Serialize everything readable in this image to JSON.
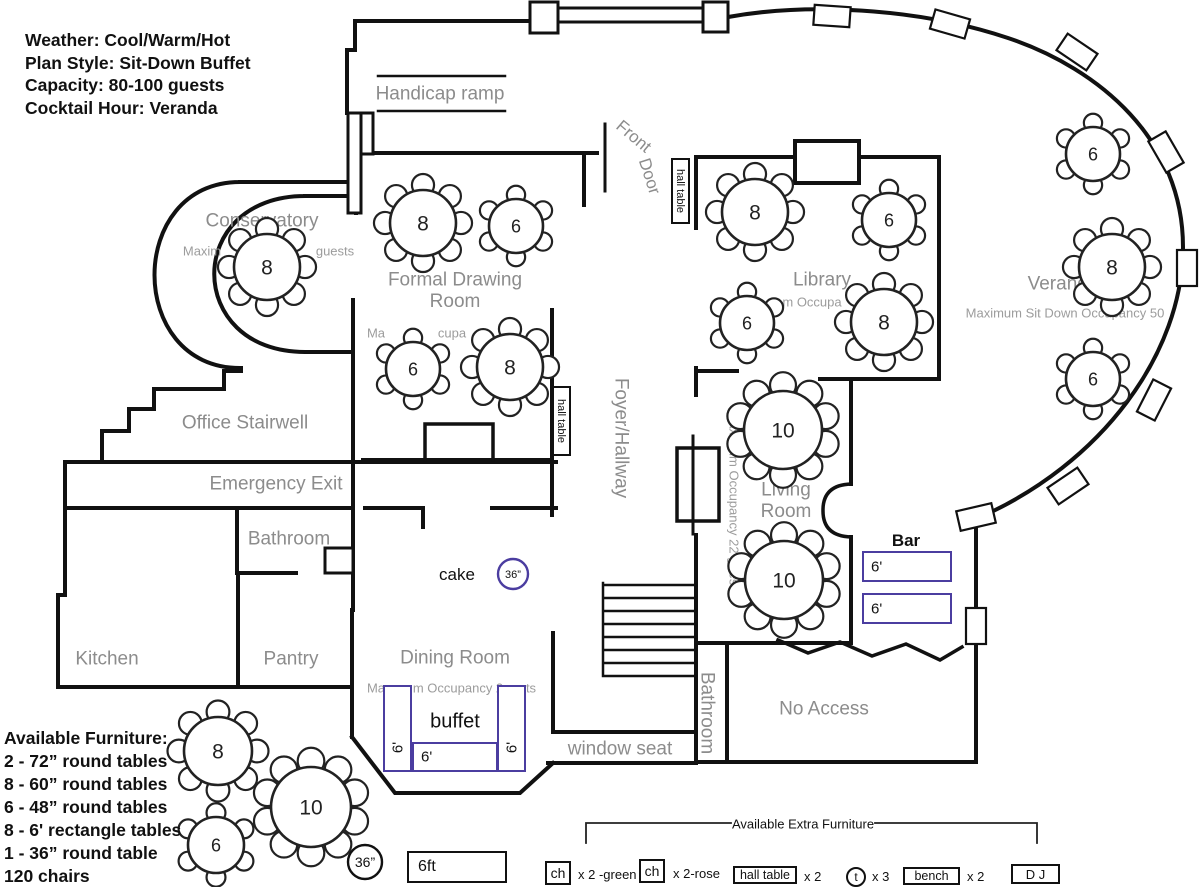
{
  "info_panel": {
    "lines": [
      "Weather: Cool/Warm/Hot",
      "Plan Style: Sit-Down Buffet",
      "Capacity: 80-100 guests",
      "Cocktail Hour: Veranda"
    ]
  },
  "furniture_panel": {
    "title": "Available Furniture:",
    "items": [
      "2 - 72” round tables",
      "8 - 60” round tables",
      "6 - 48” round tables",
      "8 - 6' rectangle tables",
      "1 - 36” round table",
      "120 chairs"
    ]
  },
  "plan": {
    "room_labels": [
      {
        "id": "conservatory",
        "text": "Conservatory",
        "x": 262,
        "y": 220,
        "size": 19,
        "rot": 0
      },
      {
        "id": "formal-drawing-room",
        "text": "Formal Drawing\nRoom",
        "x": 455,
        "y": 290,
        "size": 19,
        "rot": 0
      },
      {
        "id": "library",
        "text": "Library",
        "x": 822,
        "y": 279,
        "size": 19,
        "rot": 0
      },
      {
        "id": "veranda",
        "text": "Veranda",
        "x": 1063,
        "y": 283,
        "size": 19,
        "rot": 0
      },
      {
        "id": "office-stairwell",
        "text": "Office Stairwell",
        "x": 245,
        "y": 422,
        "size": 19,
        "rot": 0
      },
      {
        "id": "emergency-exit",
        "text": "Emergency Exit",
        "x": 276,
        "y": 483,
        "size": 19,
        "rot": 0
      },
      {
        "id": "bathroom-left",
        "text": "Bathroom",
        "x": 289,
        "y": 538,
        "size": 19,
        "rot": 0
      },
      {
        "id": "kitchen",
        "text": "Kitchen",
        "x": 107,
        "y": 658,
        "size": 19,
        "rot": 0
      },
      {
        "id": "pantry",
        "text": "Pantry",
        "x": 291,
        "y": 658,
        "size": 19,
        "rot": 0
      },
      {
        "id": "dining-room",
        "text": "Dining Room",
        "x": 455,
        "y": 657,
        "size": 19,
        "rot": 0
      },
      {
        "id": "living-room",
        "text": "Living\nRoom",
        "x": 786,
        "y": 500,
        "size": 19,
        "rot": 0
      },
      {
        "id": "foyer-hallway",
        "text": "Foyer/Hallway",
        "x": 622,
        "y": 438,
        "size": 19,
        "rot": 90
      },
      {
        "id": "bathroom-right",
        "text": "Bathroom",
        "x": 708,
        "y": 713,
        "size": 19,
        "rot": 90
      },
      {
        "id": "no-access",
        "text": "No Access",
        "x": 824,
        "y": 708,
        "size": 19,
        "rot": 0
      },
      {
        "id": "window-seat",
        "text": "window seat",
        "x": 620,
        "y": 748,
        "size": 19,
        "rot": 0
      },
      {
        "id": "handicap-ramp",
        "text": "Handicap ramp",
        "x": 440,
        "y": 93,
        "size": 19,
        "rot": 0
      },
      {
        "id": "front-door-word-1",
        "text": "Front",
        "x": 634,
        "y": 136,
        "size": 17,
        "rot": 40
      },
      {
        "id": "front-door-word-2",
        "text": "Door",
        "x": 650,
        "y": 176,
        "size": 17,
        "rot": 72
      }
    ],
    "occupancy_notes": [
      {
        "id": "conservatory-occupancy-left",
        "text": "Maxim",
        "x": 202,
        "y": 251,
        "rot": 0
      },
      {
        "id": "conservatory-occupancy-right",
        "text": "guests",
        "x": 335,
        "y": 251,
        "rot": 0
      },
      {
        "id": "formal-drawing-occupancy-left",
        "text": "Ma",
        "x": 376,
        "y": 333,
        "rot": 0
      },
      {
        "id": "formal-drawing-occupancy-right",
        "text": "cupa",
        "x": 452,
        "y": 333,
        "rot": 0
      },
      {
        "id": "library-occupancy",
        "text": "m Occupa",
        "x": 812,
        "y": 302,
        "rot": 0
      },
      {
        "id": "dining-occupancy-left",
        "text": "Ma",
        "x": 376,
        "y": 688,
        "rot": 0
      },
      {
        "id": "dining-occupancy-mid",
        "text": "m Occupancy 2",
        "x": 458,
        "y": 688,
        "rot": 0
      },
      {
        "id": "dining-occupancy-right",
        "text": "ts",
        "x": 531,
        "y": 688,
        "rot": 0
      },
      {
        "id": "living-occupancy",
        "text": "maximum Occupancy 22 guests",
        "x": 734,
        "y": 503,
        "rot": 90
      },
      {
        "id": "veranda-occupancy",
        "text": "Maximum Sit Down Occupancy 50",
        "x": 1065,
        "y": 313,
        "rot": 0
      }
    ],
    "tables": [
      {
        "id": "conservatory-table",
        "label": "8",
        "seats": 8,
        "x": 267,
        "y": 267,
        "r": 33
      },
      {
        "id": "drawing-room-table-1",
        "label": "8",
        "seats": 8,
        "x": 423,
        "y": 223,
        "r": 33
      },
      {
        "id": "drawing-room-table-2",
        "label": "6",
        "seats": 6,
        "x": 516,
        "y": 226,
        "r": 27
      },
      {
        "id": "drawing-room-table-3",
        "label": "6",
        "seats": 6,
        "x": 413,
        "y": 369,
        "r": 27
      },
      {
        "id": "drawing-room-table-4",
        "label": "8",
        "seats": 8,
        "x": 510,
        "y": 367,
        "r": 33
      },
      {
        "id": "library-table-1",
        "label": "8",
        "seats": 8,
        "x": 755,
        "y": 212,
        "r": 33
      },
      {
        "id": "library-table-2",
        "label": "6",
        "seats": 6,
        "x": 889,
        "y": 220,
        "r": 27
      },
      {
        "id": "library-table-3",
        "label": "6",
        "seats": 6,
        "x": 747,
        "y": 323,
        "r": 27
      },
      {
        "id": "library-table-4",
        "label": "8",
        "seats": 8,
        "x": 884,
        "y": 322,
        "r": 33
      },
      {
        "id": "living-room-table-1",
        "label": "10",
        "seats": 10,
        "x": 783,
        "y": 430,
        "r": 39
      },
      {
        "id": "living-room-table-2",
        "label": "10",
        "seats": 10,
        "x": 784,
        "y": 580,
        "r": 39
      },
      {
        "id": "veranda-table-1",
        "label": "6",
        "seats": 6,
        "x": 1093,
        "y": 154,
        "r": 27
      },
      {
        "id": "veranda-table-2",
        "label": "8",
        "seats": 8,
        "x": 1112,
        "y": 267,
        "r": 33
      },
      {
        "id": "veranda-table-3",
        "label": "6",
        "seats": 6,
        "x": 1093,
        "y": 379,
        "r": 27
      },
      {
        "id": "spare-table-1",
        "label": "8",
        "seats": 8,
        "x": 218,
        "y": 751,
        "r": 34
      },
      {
        "id": "spare-table-2",
        "label": "6",
        "seats": 6,
        "x": 216,
        "y": 845,
        "r": 28
      },
      {
        "id": "spare-table-3",
        "label": "10",
        "seats": 10,
        "x": 311,
        "y": 807,
        "r": 40
      }
    ],
    "small_circles": [
      {
        "id": "cake-table",
        "label": "36”",
        "x": 513,
        "y": 574,
        "r": 15,
        "color": "#4b3da0",
        "fontsize": 11
      },
      {
        "id": "legend-36-table",
        "label": "36”",
        "x": 365,
        "y": 862,
        "r": 17,
        "color": "#111111",
        "fontsize": 14
      }
    ],
    "cake_label": "cake",
    "bar": {
      "label": "Bar",
      "rects": [
        {
          "label": "6'"
        },
        {
          "label": "6'"
        }
      ]
    },
    "buffet": {
      "label": "buffet",
      "rects": [
        {
          "label": "6'"
        },
        {
          "label": "6'"
        },
        {
          "label": "6'"
        }
      ]
    },
    "hall_tables": [
      {
        "label": "hall table"
      },
      {
        "label": "hall table"
      }
    ]
  },
  "legend": {
    "title": "Available Extra Furniture",
    "rect6ft_label": "6ft",
    "items": [
      {
        "box": "ch",
        "note": "x 2 -green"
      },
      {
        "box": "ch",
        "note": "x 2-rose"
      },
      {
        "box": "hall table",
        "note": "x 2"
      },
      {
        "box": "t",
        "note": "x 3"
      },
      {
        "box": "bench",
        "note": "x 2"
      },
      {
        "box": "D J",
        "note": ""
      }
    ]
  },
  "colors": {
    "accent_purple": "#4b3da0",
    "wall": "#111111",
    "room_label": "#8c8c8c",
    "occupancy_note": "#9c9c9c"
  }
}
